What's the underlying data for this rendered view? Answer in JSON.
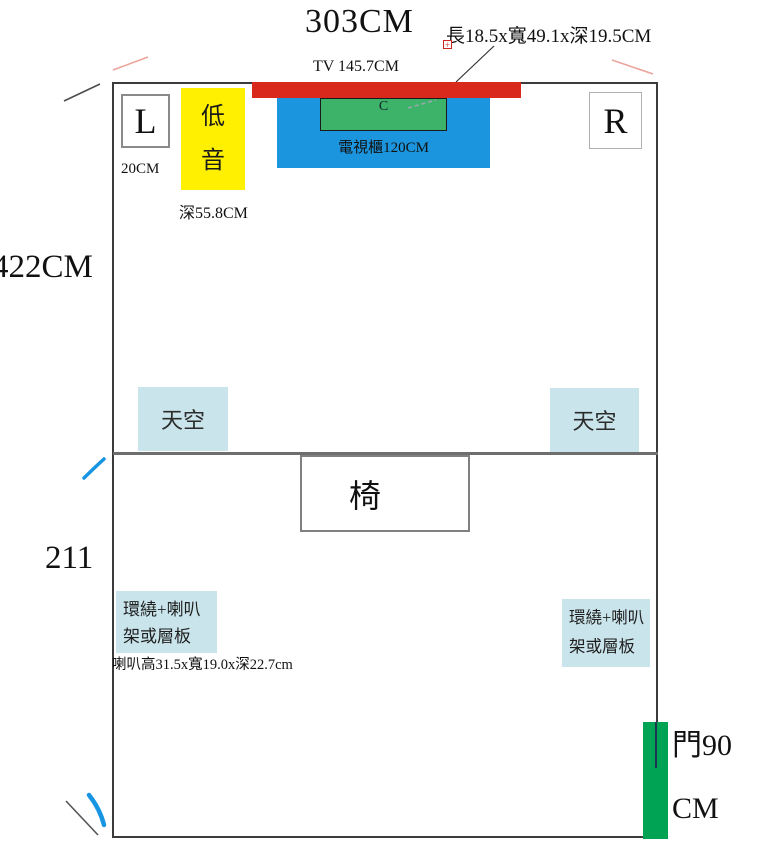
{
  "header": {
    "room_width_label": "303CM",
    "center_dims_label": "長18.5x寬49.1x深19.5CM",
    "tv_label": "TV 145.7CM"
  },
  "walls": {
    "upper_depth_label": "422CM",
    "lower_depth_label": "211"
  },
  "front_stage": {
    "left_speaker": "L",
    "left_speaker_offset": "20CM",
    "subwoofer": "低音",
    "subwoofer_depth": "深55.8CM",
    "center_speaker": "C",
    "tv_cabinet": "電視櫃120CM",
    "right_speaker": "R"
  },
  "ceiling_speakers": {
    "left": "天空",
    "right": "天空"
  },
  "seating": {
    "chair": "椅"
  },
  "surrounds": {
    "left_line1": "環繞+喇叭",
    "left_line2": "架或層板",
    "right_line1": "環繞+喇叭",
    "right_line2": "架或層板",
    "size_note": "喇叭高31.5x寬19.0x深22.7cm"
  },
  "door": {
    "line1": "門90",
    "line2": "CM"
  },
  "icons": {
    "anchor_marker": "+"
  },
  "colors": {
    "tv_red": "#d9291c",
    "subwoofer_yellow": "#ffef00",
    "cabinet_blue": "#1b95dd",
    "center_green": "#3db36a",
    "door_green": "#00a254",
    "ceiling_blue": "#c9e4eb"
  }
}
